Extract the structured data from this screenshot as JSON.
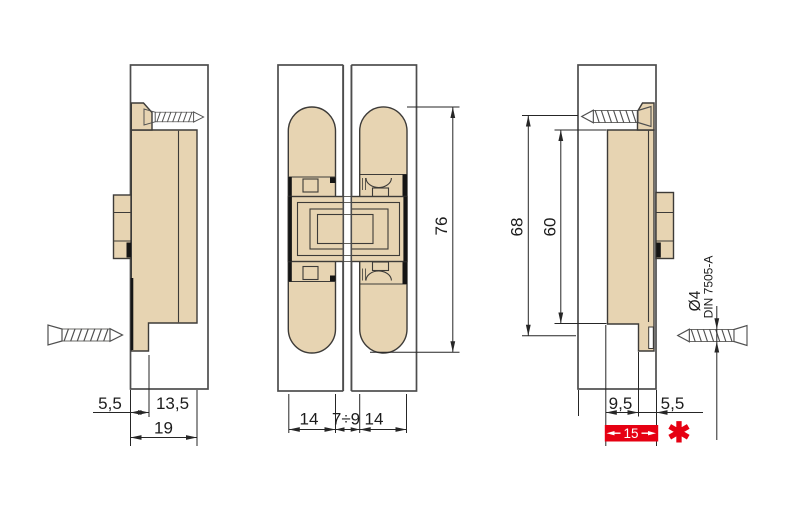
{
  "drawing": {
    "colors": {
      "part_fill": "#e7d4b2",
      "outline": "#3d3b38",
      "panel_outline": "#4d4d4d",
      "dim": "#262626",
      "screw": "#4f4f4f",
      "highlight_red": "#e60012",
      "detail_black": "#151515"
    },
    "left_view": {
      "dim_offset": "5,5",
      "dim_plate": "13,5",
      "dim_total": "19"
    },
    "middle_view": {
      "dim_body_left": "14",
      "dim_gap": "7÷9",
      "dim_body_right": "14",
      "dim_length": "76"
    },
    "right_view": {
      "dim_screw_axes": "68",
      "dim_plate_length": "60",
      "dim_recess": "9,5",
      "dim_offset": "5,5",
      "dim_highlight_total": "15",
      "footnote_marker": "✱"
    },
    "screw_spec": {
      "diameter": "Ø4",
      "standard": "DIN 7505-A"
    }
  }
}
